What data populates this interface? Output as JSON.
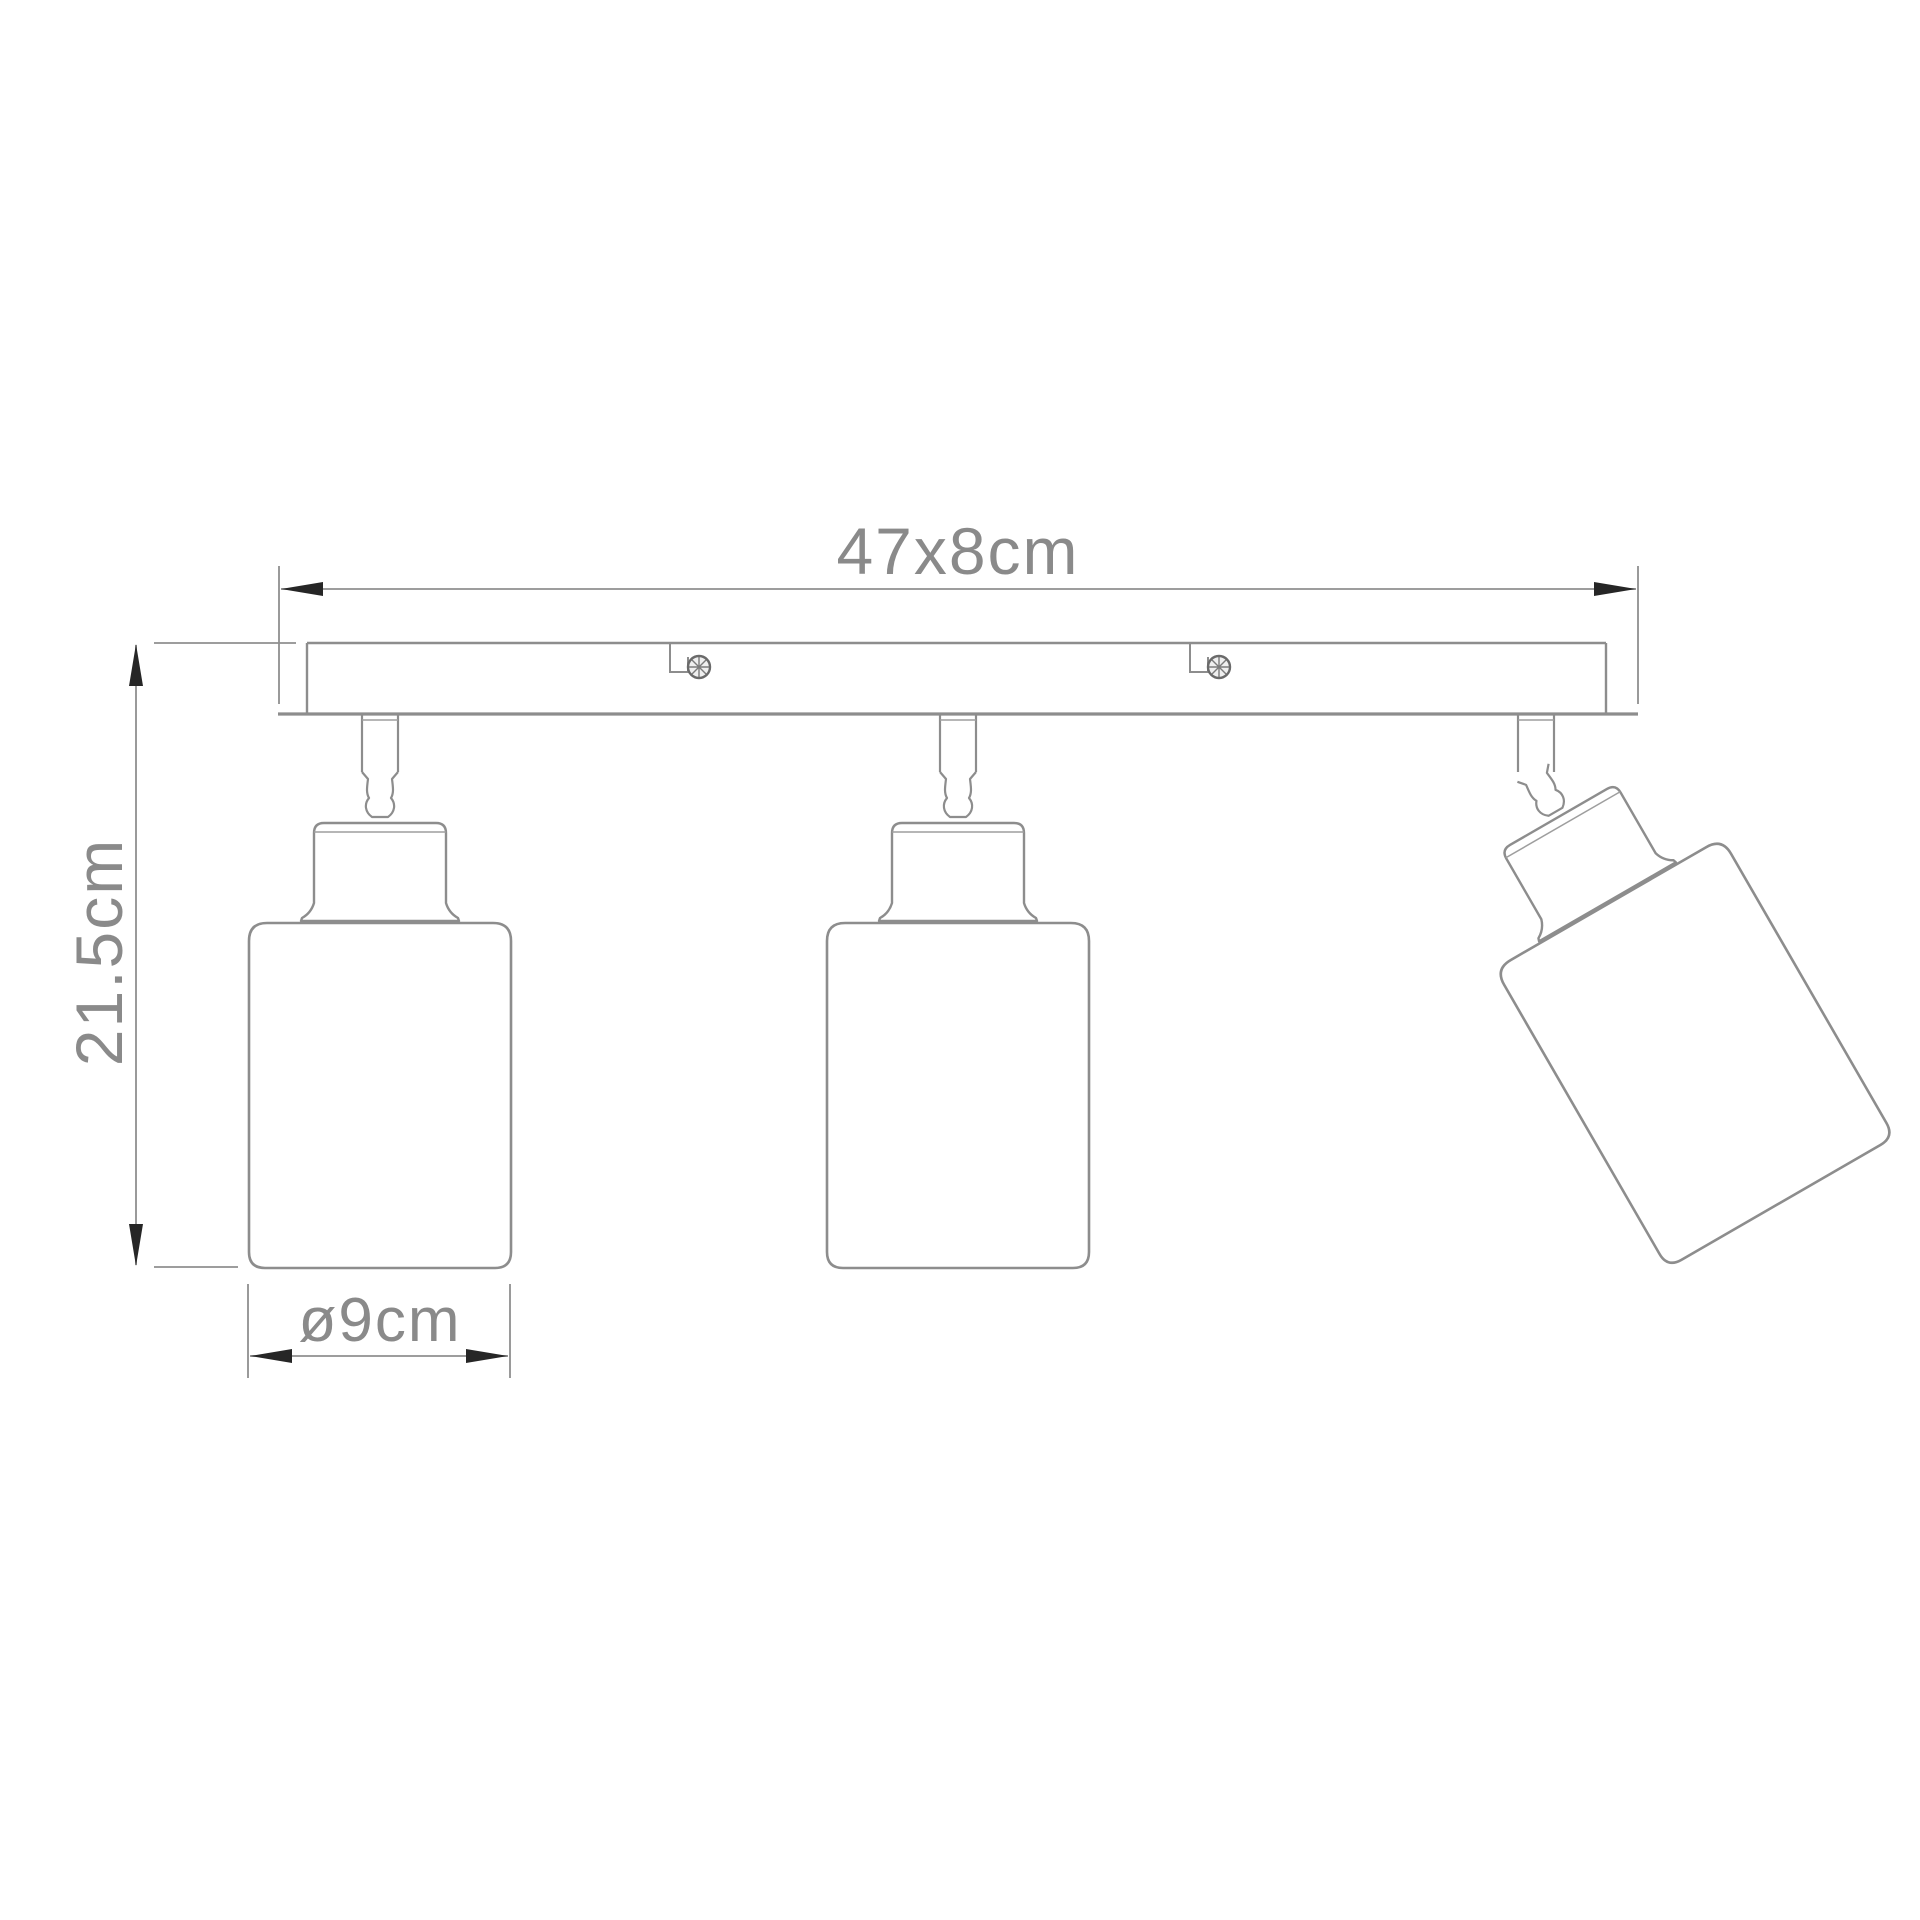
{
  "drawing": {
    "type": "technical-dimension-drawing",
    "subject": "three-spot ceiling light bar",
    "lamp_count": 3,
    "screw_slot_count": 2
  },
  "dimensions": {
    "bar": {
      "label": "47x8cm"
    },
    "height": {
      "label": "21.5cm"
    },
    "shade_diameter": {
      "label": "ø9cm"
    }
  },
  "colors": {
    "background": "#ffffff",
    "outline": "#8d8d8d",
    "dimension_line": "#8f8f8f",
    "arrow": "#262626",
    "label_text": "#8a8a8a",
    "screw": "#6a6a6a"
  }
}
